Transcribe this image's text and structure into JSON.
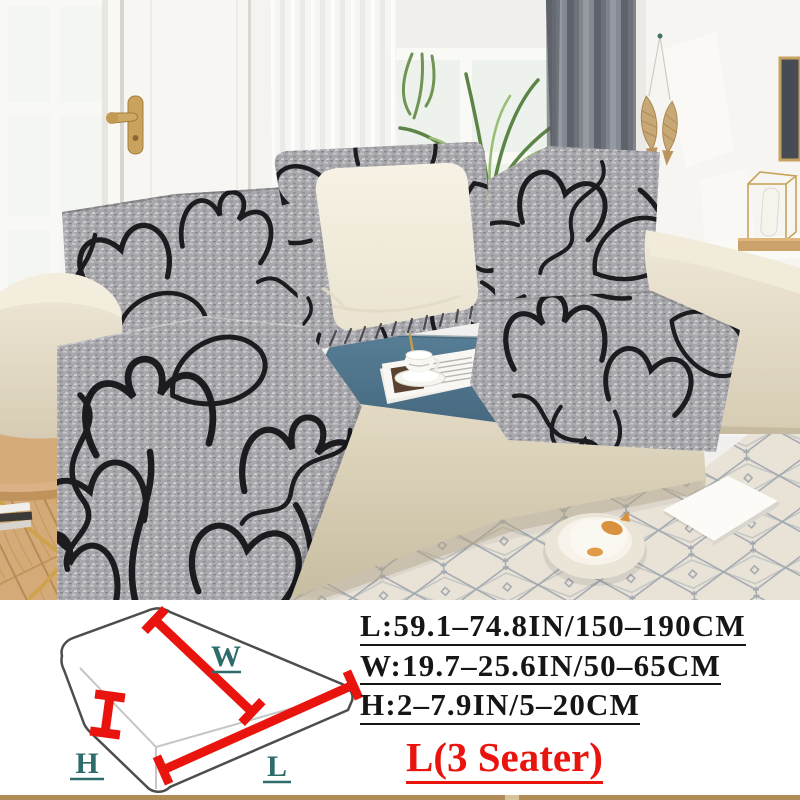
{
  "size_panel": {
    "spec_lines": [
      "L:59.1–74.8IN/150–190CM",
      "W:19.7–25.6IN/50–65CM",
      "H:2–7.9IN/5–20CM"
    ],
    "variant_label": "L(3 Seater)",
    "diagram": {
      "width_label": "W",
      "length_label": "L",
      "height_label": "H"
    }
  },
  "colors": {
    "accent_red": "#e9140d",
    "label_teal": "#2e6b6b",
    "text_black": "#161616",
    "panel_bg": "#ffffff",
    "divider_tan": "#b08a57",
    "fabric_gray": "#a7a7ac",
    "pattern_black": "#17171b",
    "sofa_beige": "#e4dcc7",
    "platform_blue": "#527b92",
    "cushion_inner_cream": "#f4efe1",
    "curtain_gray": "#7e828a",
    "rug_cream": "#e8e2d7",
    "wood_floor": "#d4aa78"
  }
}
